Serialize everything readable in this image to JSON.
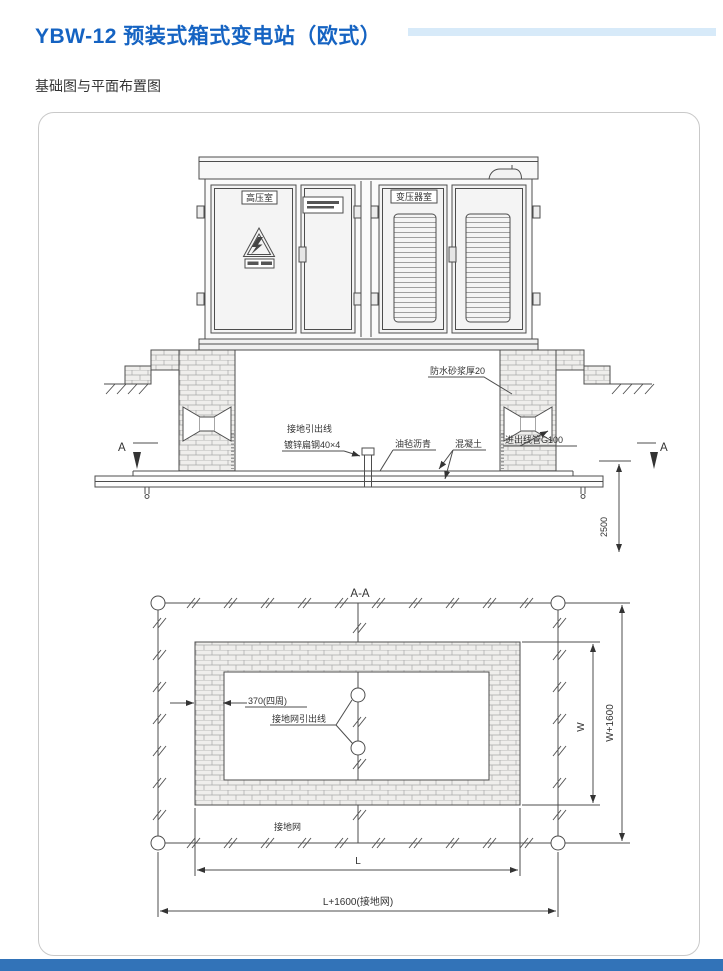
{
  "header": {
    "title": "YBW-12 预装式箱式变电站（欧式）",
    "subtitle": "基础图与平面布置图"
  },
  "colors": {
    "title_blue": "#1563c2",
    "accent_bar": "#d7eaf9",
    "footer_bar": "#3273b8",
    "drawing_line": "#4d4d4d"
  },
  "elevation": {
    "room_labels": {
      "hv_room": "高压室",
      "transformer_room": "变压器室"
    },
    "annotations": {
      "waterproof_mortar": "防水砂浆厚20",
      "ground_lead": "接地引出线",
      "flat_steel": "镀锌扁钢40×4",
      "felt_asphalt": "油毡沥青",
      "concrete": "混凝土",
      "conduit": "进出线管G100",
      "section_a_left": "A",
      "section_a_right": "A",
      "depth": "2500"
    }
  },
  "plan": {
    "section_title": "A-A",
    "annotations": {
      "wall_thickness": "370(四周)",
      "grid_lead": "接地网引出线",
      "ground_grid": "接地网"
    },
    "dimensions": {
      "inner_length": "L",
      "outer_length": "L+1600(接地网)",
      "inner_width": "W",
      "outer_width": "W+1600"
    }
  }
}
